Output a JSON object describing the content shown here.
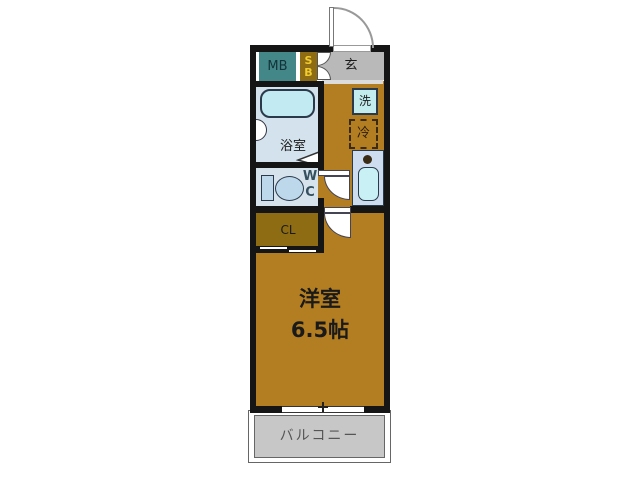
{
  "floorplan": {
    "main_room": {
      "name": "洋室",
      "size": "6.5帖"
    },
    "balcony": {
      "label": "バルコニー"
    },
    "entrance": {
      "label": "玄"
    },
    "bathroom": {
      "label": "浴室"
    },
    "toilet": {
      "label_top": "W",
      "label_bottom": "C"
    },
    "closet": {
      "label": "CL"
    },
    "meter_box": {
      "label": "MB"
    },
    "shoe_box": {
      "label_top": "S",
      "label_bottom": "B"
    },
    "washer": {
      "label": "洗"
    },
    "refrigerator": {
      "label": "冷"
    },
    "colors": {
      "wall": "#151515",
      "main_room_floor": "#b37e21",
      "closet_fill": "#8d6c13",
      "shoe_box_fill": "#8d6c13",
      "shoe_box_text": "#f0cc30",
      "meter_box_fill": "#448789",
      "entrance_floor": "#b9b9b9",
      "balcony_floor": "#c7c7c7",
      "bathroom_floor": "#d3e2ec",
      "wc_floor": "#d6e3ed",
      "counter_fill": "#cddcee",
      "tub_fill": "#c2eaf2",
      "sink_fill": "#c9f0f4",
      "washer_fill": "#c2ecee"
    }
  }
}
